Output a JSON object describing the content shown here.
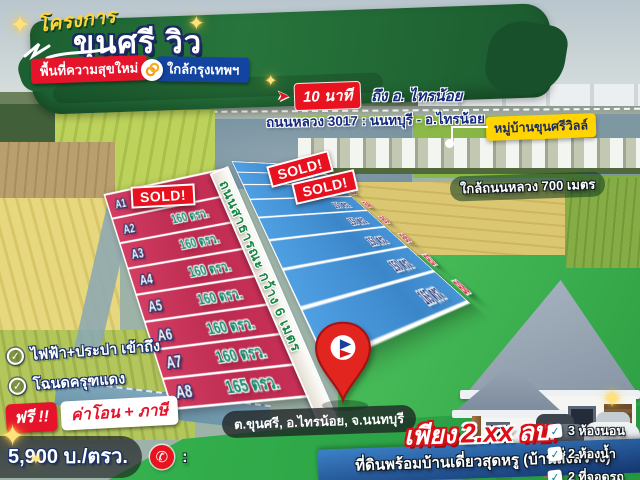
{
  "banner": {
    "project_label": "โครงการ",
    "title": "ขุนศรี วิว",
    "tag_red": "พื้นที่ความสุขใหม่",
    "tag_blue": "ใกล้กรุงเทพฯ"
  },
  "route": {
    "time": "10 นาที",
    "destination": "ถึง อ. ไทรน้อย",
    "highway": "ถนนหลวง 3017 : นนทบุรี - อ.ไทรน้อย"
  },
  "landmarks": {
    "village": "หมู่บ้านขุนศรีวิลล์",
    "road_distance": "ใกล้ถนนหลวง 700 เมตร"
  },
  "plot_map": {
    "sold_label": "SOLD!",
    "road_label": "ถนนสาธารณะ กว้าง 6 เมตร",
    "zone_a": [
      {
        "id": "A1",
        "size": ""
      },
      {
        "id": "A2",
        "size": "160 ตรว."
      },
      {
        "id": "A3",
        "size": "160 ตรว."
      },
      {
        "id": "A4",
        "size": "160 ตรว."
      },
      {
        "id": "A5",
        "size": "160 ตรว."
      },
      {
        "id": "A6",
        "size": "160 ตรว."
      },
      {
        "id": "A7",
        "size": "160 ตรว."
      },
      {
        "id": "A8",
        "size": "165 ตรว."
      }
    ],
    "zone_b": [
      {
        "id": "",
        "size": "248 ตรว."
      },
      {
        "id": "B2",
        "size": "200 ตรว."
      },
      {
        "id": "B3",
        "size": "150 ตรว."
      },
      {
        "id": "B4",
        "size": "150 ตรว."
      },
      {
        "id": "B5",
        "size": "150 ตรว."
      },
      {
        "id": "B6",
        "size": "150 ตรว."
      },
      {
        "id": "B7",
        "size": "150 ตรว."
      },
      {
        "id": "B8",
        "size": "165 ตรว."
      }
    ]
  },
  "features": [
    "ไฟฟ้า+ประปา เข้าถึง",
    "โฉนดครุฑแดง"
  ],
  "promo": {
    "free": "ฟรี !!",
    "items": "ค่าโอน + ภาษี"
  },
  "price": {
    "per_sqwa": "5,900 บ./ตรว.",
    "phone_separator": ":"
  },
  "location": {
    "address": "ต.ขุนศรี, อ.ไทรน้อย, จ.นนทบุรี"
  },
  "offer": {
    "only": "เพียง",
    "amount": "2.xx",
    "unit": "ลบ.",
    "description": "ที่ดินพร้อมบ้านเดี่ยวสุดหรู (บ้านสั่งสร้าง)"
  },
  "house_features": [
    "3 ห้องนอน",
    "2 ห้องน้ำ",
    "2 ที่จอดรถ"
  ],
  "icons": {
    "sparkle": "✦",
    "check": "✓",
    "phone": "✆",
    "arrow": "➤"
  },
  "colors": {
    "brand_green": "#1d6132",
    "accent_red": "#e6142b",
    "accent_blue": "#1345a0",
    "badge_yellow": "#ffd400",
    "plot_red": "#cf3558",
    "plot_blue": "#4596db",
    "sold_red": "#e8111f",
    "offer_red": "#e20d16"
  }
}
